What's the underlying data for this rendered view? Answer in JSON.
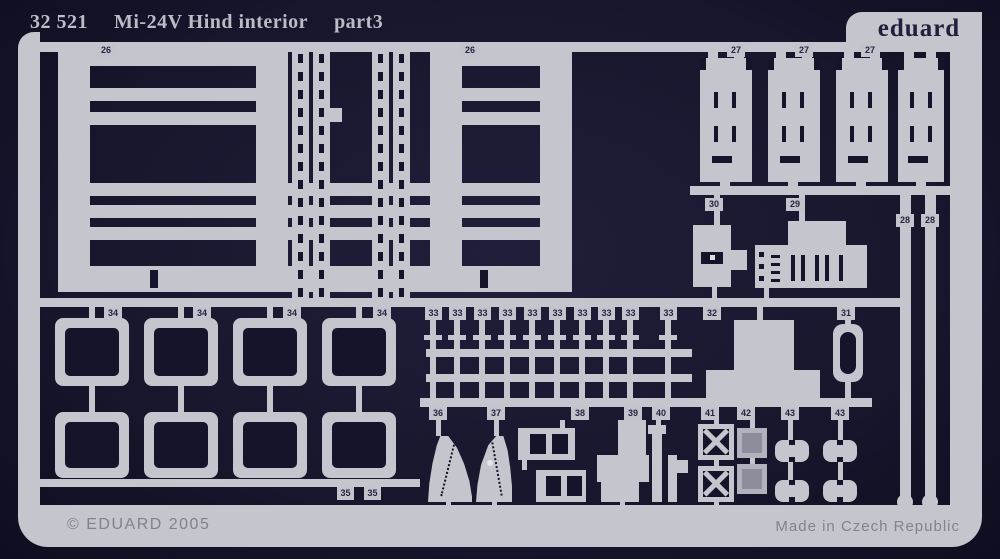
{
  "header": {
    "catalog_no": "32 521",
    "title": "Mi-24V Hind interior",
    "part_suffix": "part3",
    "brand": "eduard"
  },
  "footer": {
    "copyright": "© EDUARD 2005",
    "origin": "Made in Czech Republic"
  },
  "colors": {
    "background": "#16162c",
    "metal": "#c5c5cd",
    "metal_dim": "#b2b2be",
    "etch_dark": "#14142a",
    "label_ink": "#252545",
    "title_ink": "#bcbcc7",
    "footer_ink": "#82828d"
  },
  "labels": {
    "l26": [
      "26",
      "26"
    ],
    "l27": [
      "27",
      "27",
      "27"
    ],
    "l28": [
      "28",
      "28"
    ],
    "l29": "29",
    "l30": "30",
    "l31": "31",
    "l32": "32",
    "l33": [
      "33",
      "33",
      "33",
      "33",
      "33",
      "33",
      "33",
      "33",
      "33",
      "33"
    ],
    "l34": [
      "34",
      "34",
      "34",
      "34"
    ],
    "l35": [
      "35",
      "35"
    ],
    "l36": "36",
    "l37": "37",
    "l38": "38",
    "l39": "39",
    "l40": "40",
    "l41": "41",
    "l42": "42",
    "l43": [
      "43",
      "43"
    ]
  }
}
